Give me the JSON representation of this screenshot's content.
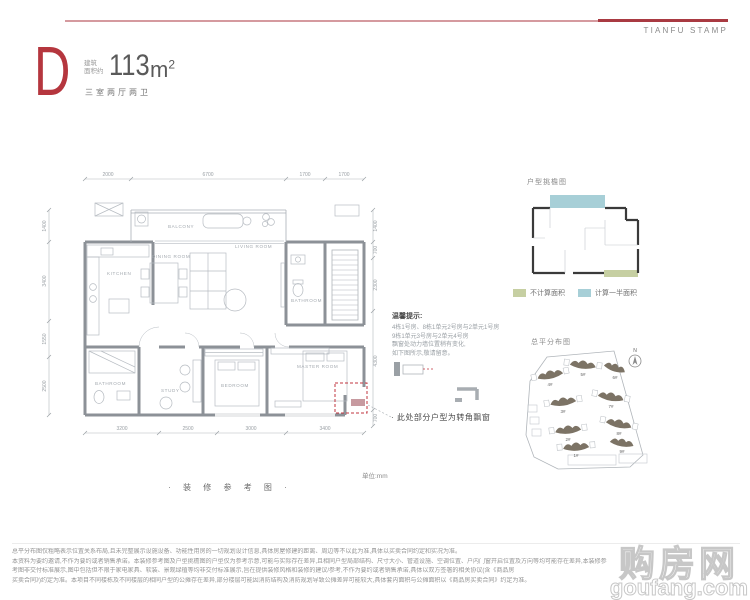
{
  "brand": {
    "name": "TIANFU STAMP"
  },
  "header": {
    "unit_letter": "D",
    "area_label_line1": "建筑",
    "area_label_line2": "面积约",
    "area_value": "113",
    "area_unit_base": "m",
    "area_unit_sup": "2",
    "layout_text": "三室两厅两卫"
  },
  "floorplan": {
    "caption": "· 装 修 参 考 图 ·",
    "unit_note": "单位:mm",
    "annotation": "· 此处部分户型为转角飘窗",
    "rooms": {
      "balcony": "BALCONY",
      "kitchen": "KITCHEN",
      "dining": "DINING ROOM",
      "living": "LIVING ROOM",
      "bath_top": "BATHROOM",
      "bath_bottom": "BATHROOM",
      "study": "STUDY",
      "bedroom": "BEDROOM",
      "master": "MASTER ROOM"
    },
    "dims_top": [
      "2000",
      "6700",
      "1700",
      "1700"
    ],
    "dims_bottom": [
      "3200",
      "2500",
      "3000",
      "3400"
    ],
    "dims_left": [
      "1400",
      "3400",
      "1550",
      "2500"
    ],
    "dims_right": [
      "1400",
      "700",
      "2300",
      "4300",
      "700"
    ]
  },
  "notice": {
    "title": "温馨提示:",
    "lines": [
      "4栋1号房、8栋1单元2号房与2单元1号房",
      "9栋1单元3号房与2单元4号房",
      "飘窗处动力墙位置稍有变化,",
      "如下图所示,敬请留意。"
    ]
  },
  "eaves_diagram": {
    "title": "户型挑檐图",
    "legend": [
      {
        "label": "不计算面积",
        "color": "#c6cfa2"
      },
      {
        "label": "计算一半面积",
        "color": "#a7cfd7"
      }
    ]
  },
  "site_plan": {
    "title": "总平分布图",
    "north_label": "N",
    "buildings": [
      "4#",
      "5#",
      "6#",
      "3#",
      "7#",
      "2#",
      "8#",
      "1#",
      "9#"
    ]
  },
  "disclaimer": {
    "lines": [
      "总平分布图仅粗略表示位置关系布局,且未完整展示设施设备、功能性用房的一切规划设计信息,具体房屋修建的距离、周边等不以此为准,具体以买卖合同约定和实况为准。",
      "本资料为要约邀请,不作为要约或者销售承诺。本装修参考图及户型挑檐图的户型仅为参考示意,可能与实际存在差异,且相同户型局部结构、尺寸大小、管道设施、空调位置、户内门窗开启位置及方向等均可能存在差异,本装修参",
      "考图非交付标准展示,图中包括但不限于家电家具、软装、景观绿植等均非交付标准展示,旨在提供装修风格和装修的建议/参考,不作为要约或者销售承诺,具体以双方签署的相关协议(含《商品房",
      "买卖合同》)约定为准。本项目不同楼栋及不同楼层的相同户型的公摊存在差异,部分楼层可能因消防结构及消防规划导致公摊差异可能较大,具体套内面积与公摊面积以《商品房买卖合同》约定为准。"
    ]
  },
  "watermark": {
    "cn": "购房网",
    "en": "goufang.com"
  },
  "colors": {
    "accent_red": "#b5363e",
    "rule_light": "#d59a9f",
    "rule_dark": "#a93a42",
    "plan_line": "#9aa0a6",
    "wall": "#8c9197",
    "dash_red": "#c0353f",
    "eaves_green": "#c6cfa2",
    "eaves_teal": "#a7cfd7",
    "building": "#7c7365"
  }
}
